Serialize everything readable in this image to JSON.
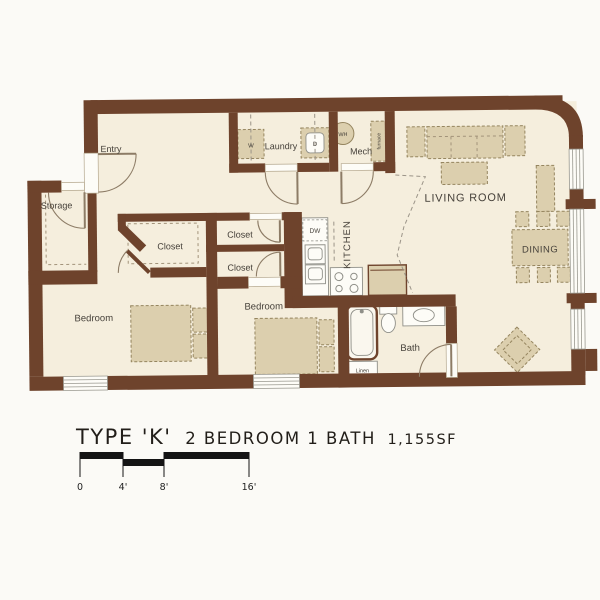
{
  "title": {
    "type_label": "TYPE 'K'",
    "specs": "2 BEDROOM 1 BATH",
    "area": "1,155SF"
  },
  "rooms": {
    "entry": "Entry",
    "storage": "Storage",
    "laundry": "Laundry",
    "mech": "Mech",
    "living_room": "LIVING ROOM",
    "dining": "DINING",
    "kitchen": "KITCHEN",
    "walkin_closet": "Closet",
    "hall_closet_top": "Closet",
    "hall_closet_bottom": "Closet",
    "bedroom_1": "Bedroom",
    "bedroom_2": "Bedroom",
    "bath": "Bath",
    "linen": "Linen"
  },
  "appliances": {
    "washer": "W",
    "dryer": "D",
    "water_heater": "WH",
    "furnace": "furnace",
    "dishwasher": "DW"
  },
  "scale_bar": {
    "ticks": [
      "0",
      "4'",
      "8'",
      "16'"
    ]
  },
  "colors": {
    "wall": "#6e432c",
    "floor": "#f5eedd",
    "furniture": "#dccfae",
    "paper": "#fbfaf6"
  }
}
